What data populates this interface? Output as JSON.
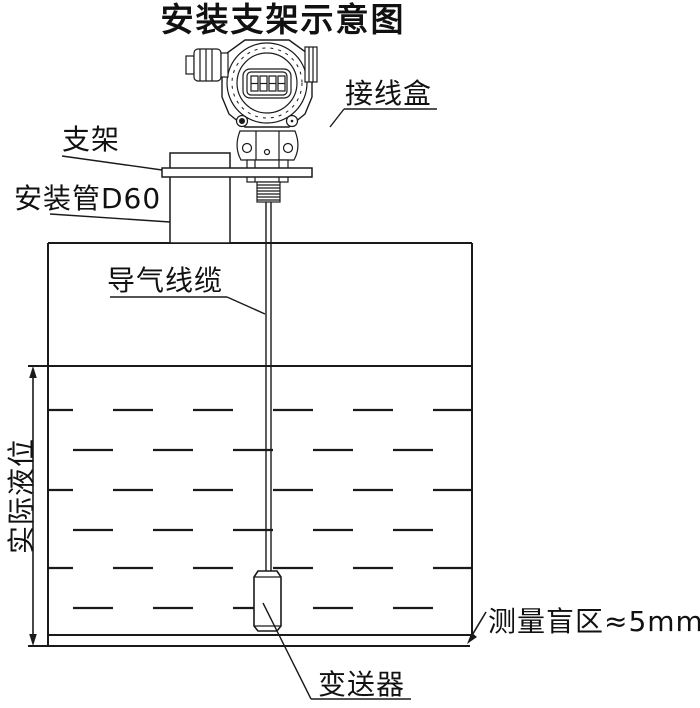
{
  "title": "安装支架示意图",
  "labels": {
    "junction_box": "接线盒",
    "bracket": "支架",
    "mounting_pipe": "安装管D60",
    "air_cable": "导气线缆",
    "actual_level": "实际液位",
    "blind_zone": "测量盲区≈5mm",
    "transmitter": "变送器"
  },
  "colors": {
    "line": "#1a1a1a",
    "background": "#ffffff"
  }
}
